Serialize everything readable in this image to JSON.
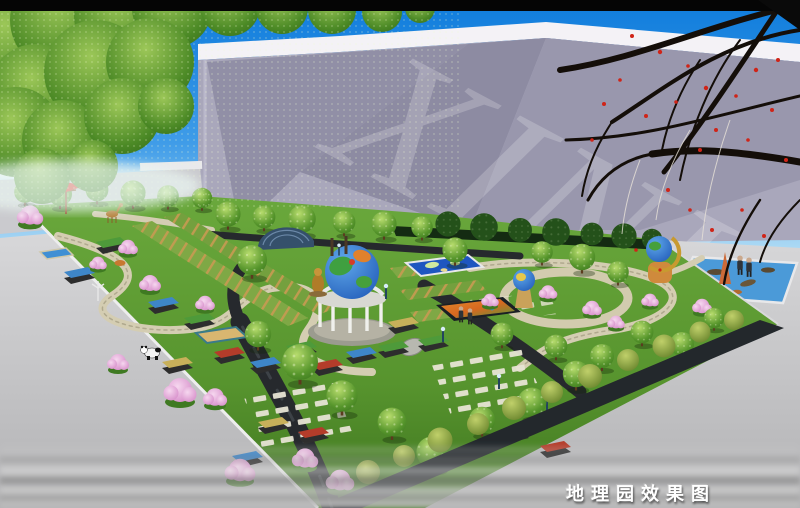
{
  "image": {
    "title_caption": "地理园效果图",
    "watermark": "XINK"
  },
  "palette": {
    "sky_top": "#1486e0",
    "sky_horizon": "#a5d6f4",
    "building_face": "#a9a7bb",
    "building_shadow": "#8d8ba2",
    "building_top_band": "#f4f2f6",
    "lawn_green": "#5d9c33",
    "lawn_shadow": "#3f751f",
    "stone_path": "#d4cdb2",
    "asphalt_path": "#26292d",
    "plaza_gray": "#c9c9cb",
    "hedge_wall": "#1d2327",
    "pool_blue": "#4b9ad8",
    "blossom_pink": "#e3a2d6",
    "autumn_flower_red": "#c8281c",
    "flag_red": "#e02818",
    "globe_ocean": "#1c54b4",
    "caption_color": "#ffffff"
  },
  "scene_elements": [
    "globe-pavilion",
    "world-map-model",
    "china-relief-map",
    "pergola-trellis-rows",
    "panda-sculpture",
    "deer-sculpture",
    "globe-sculptures",
    "fish-pool",
    "red-flag",
    "exhibit-pedestals",
    "stepping-stones",
    "building-backdrop",
    "autumn-branches",
    "tree-canopy",
    "surrounding-plaza",
    "visitors"
  ]
}
